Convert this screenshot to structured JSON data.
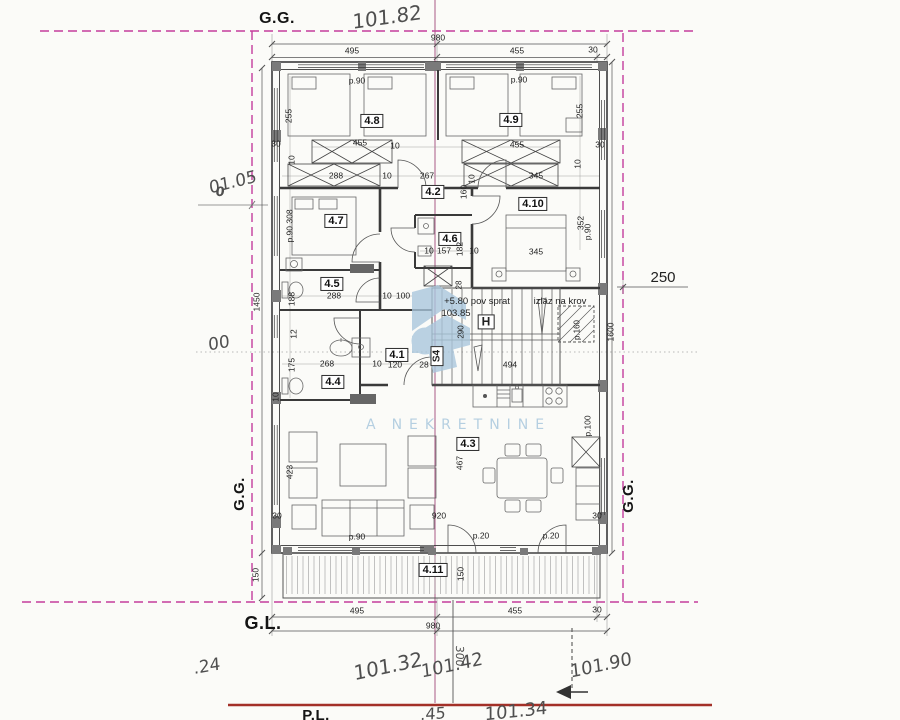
{
  "colors": {
    "boundary": "#c43c9c",
    "survey_line": "#a85a86",
    "ground_line": "#a33028",
    "ink": "#3a3a3a",
    "watermark": "#a9c6dc"
  },
  "watermark": {
    "prefix": "A",
    "text": "NEKRETNINE"
  },
  "texts": {
    "site": [
      {
        "n": "gg-top-label",
        "t": "G.G.",
        "x": 277,
        "y": 19
      },
      {
        "n": "gg-left-label",
        "t": "G.G.",
        "x": 240,
        "y": 494,
        "r": -90,
        "fs": 15
      },
      {
        "n": "gg-right-label",
        "t": "G.G.",
        "x": 629,
        "y": 496,
        "r": -90,
        "fs": 15
      },
      {
        "n": "gl-bottom-label",
        "t": "G.L.",
        "x": 263,
        "y": 624,
        "fs": 18
      },
      {
        "n": "pl-bottom-label",
        "t": "P.L.",
        "x": 316,
        "y": 716,
        "fs": 15
      }
    ],
    "hand": [
      {
        "n": "elevation-top",
        "t": "101.82",
        "x": 387,
        "y": 17,
        "r": -8,
        "fs": 20
      },
      {
        "n": "elevation-left-upper",
        "t": "01.05",
        "x": 233,
        "y": 183,
        "r": -14,
        "fs": 17
      },
      {
        "n": "elevation-left-zero",
        "t": "0",
        "x": 220,
        "y": 193,
        "fs": 13,
        "b": 1
      },
      {
        "n": "elevation-left-lower",
        "t": "00",
        "x": 219,
        "y": 344,
        "r": -10,
        "fs": 17
      },
      {
        "n": "elevation-bottom-24",
        "t": ".24",
        "x": 207,
        "y": 667,
        "r": -10,
        "fs": 17
      },
      {
        "n": "elevation-bottom-10132",
        "t": "101.32",
        "x": 388,
        "y": 666,
        "r": -12,
        "fs": 20
      },
      {
        "n": "elevation-bottom-10142",
        "t": "101.42",
        "x": 452,
        "y": 666,
        "r": -12,
        "fs": 18
      },
      {
        "n": "elevation-bottom-10190",
        "t": "101.90",
        "x": 601,
        "y": 666,
        "r": -12,
        "fs": 18
      },
      {
        "n": "elevation-bottom-45",
        "t": ".45",
        "x": 433,
        "y": 714,
        "r": -4,
        "fs": 16
      },
      {
        "n": "elevation-bottom-10134",
        "t": "101.34",
        "x": 516,
        "y": 712,
        "r": -6,
        "fs": 18
      },
      {
        "n": "survey-300",
        "t": "300",
        "x": 459,
        "y": 656,
        "r": 90,
        "fs": 11
      }
    ],
    "rooms": [
      {
        "n": "room-label-4-8",
        "t": "4.8",
        "x": 372,
        "y": 121
      },
      {
        "n": "room-label-4-9",
        "t": "4.9",
        "x": 511,
        "y": 120
      },
      {
        "n": "room-label-4-2",
        "t": "4.2",
        "x": 433,
        "y": 192
      },
      {
        "n": "room-label-4-7",
        "t": "4.7",
        "x": 336,
        "y": 221
      },
      {
        "n": "room-label-4-10",
        "t": "4.10",
        "x": 533,
        "y": 204
      },
      {
        "n": "room-label-4-6",
        "t": "4.6",
        "x": 450,
        "y": 239
      },
      {
        "n": "room-label-4-5",
        "t": "4.5",
        "x": 332,
        "y": 284
      },
      {
        "n": "room-label-4-1",
        "t": "4.1",
        "x": 397,
        "y": 355
      },
      {
        "n": "room-label-4-4",
        "t": "4.4",
        "x": 333,
        "y": 382
      },
      {
        "n": "room-label-4-3",
        "t": "4.3",
        "x": 468,
        "y": 444
      },
      {
        "n": "room-label-4-11",
        "t": "4.11",
        "x": 433,
        "y": 570
      }
    ],
    "stair": [
      {
        "n": "stair-h-label",
        "t": "H",
        "x": 486,
        "y": 322,
        "box": 1,
        "b": 1,
        "fs": 12
      },
      {
        "n": "stair-s4-label",
        "t": "S4",
        "x": 437,
        "y": 356,
        "box": 1,
        "b": 1,
        "fs": 10,
        "r": -90
      },
      {
        "n": "level-note",
        "t": "+5.80 pov sprat",
        "x": 477,
        "y": 302
      },
      {
        "n": "level-value",
        "t": "103.85",
        "x": 456,
        "y": 314
      },
      {
        "n": "roof-exit-note",
        "t": "izlaz na krov",
        "x": 560,
        "y": 302
      },
      {
        "n": "dim-494",
        "t": "494",
        "x": 510,
        "y": 365,
        "fs": 8.5
      },
      {
        "n": "dim-p160",
        "t": "p.160",
        "x": 578,
        "y": 330,
        "r": -90,
        "fs": 8
      },
      {
        "n": "dim-290",
        "t": "290",
        "x": 462,
        "y": 332,
        "r": -90,
        "fs": 8
      },
      {
        "n": "dim-28-stair",
        "t": "28",
        "x": 460,
        "y": 285,
        "r": -90,
        "fs": 8
      }
    ],
    "dims": [
      {
        "n": "dim-top-980",
        "t": "980",
        "x": 438,
        "y": 38
      },
      {
        "n": "dim-top-495",
        "t": "495",
        "x": 352,
        "y": 51
      },
      {
        "n": "dim-top-455",
        "t": "455",
        "x": 517,
        "y": 51
      },
      {
        "n": "dim-top-30",
        "t": "30",
        "x": 593,
        "y": 50
      },
      {
        "n": "dim-bottom-495",
        "t": "495",
        "x": 357,
        "y": 611
      },
      {
        "n": "dim-bottom-455",
        "t": "455",
        "x": 515,
        "y": 611
      },
      {
        "n": "dim-bottom-30",
        "t": "30",
        "x": 597,
        "y": 610
      },
      {
        "n": "dim-bottom-980",
        "t": "980",
        "x": 433,
        "y": 626
      },
      {
        "n": "dim-left-1450",
        "t": "1450",
        "x": 257,
        "y": 302,
        "r": -90
      },
      {
        "n": "dim-left-150",
        "t": "150",
        "x": 256,
        "y": 575,
        "r": -90
      },
      {
        "n": "dim-right-1600",
        "t": "1600",
        "x": 611,
        "y": 332,
        "r": -90
      },
      {
        "n": "dim-right-250",
        "t": "250",
        "x": 663,
        "y": 278,
        "fs": 15
      },
      {
        "n": "dim-p90-room48",
        "t": "p.90",
        "x": 357,
        "y": 81
      },
      {
        "n": "dim-p90-room49",
        "t": "p.90",
        "x": 519,
        "y": 80
      },
      {
        "n": "dim-255-left",
        "t": "255",
        "x": 289,
        "y": 116,
        "r": -90
      },
      {
        "n": "dim-255-right",
        "t": "255",
        "x": 580,
        "y": 111,
        "r": -90
      },
      {
        "n": "dim-30-tl",
        "t": "30",
        "x": 276,
        "y": 144
      },
      {
        "n": "dim-10-a",
        "t": "10",
        "x": 292,
        "y": 160,
        "r": -90
      },
      {
        "n": "dim-455-wl",
        "t": "455",
        "x": 360,
        "y": 143
      },
      {
        "n": "dim-10-b",
        "t": "10",
        "x": 395,
        "y": 146
      },
      {
        "n": "dim-288-w",
        "t": "288",
        "x": 336,
        "y": 176
      },
      {
        "n": "dim-10-c",
        "t": "10",
        "x": 387,
        "y": 176
      },
      {
        "n": "dim-267",
        "t": "267",
        "x": 427,
        "y": 176
      },
      {
        "n": "dim-160",
        "t": "160",
        "x": 464,
        "y": 192,
        "r": -90
      },
      {
        "n": "dim-455-wr",
        "t": "455",
        "x": 517,
        "y": 145
      },
      {
        "n": "dim-30-tr",
        "t": "30",
        "x": 600,
        "y": 145
      },
      {
        "n": "dim-10-d",
        "t": "10",
        "x": 578,
        "y": 164,
        "r": -90
      },
      {
        "n": "dim-345-w",
        "t": "345",
        "x": 536,
        "y": 176
      },
      {
        "n": "dim-10-e",
        "t": "10",
        "x": 472,
        "y": 179,
        "r": -90
      },
      {
        "n": "dim-p90-308",
        "t": "p.90 308",
        "x": 290,
        "y": 226,
        "r": -90
      },
      {
        "n": "dim-345-room410",
        "t": "345",
        "x": 536,
        "y": 252
      },
      {
        "n": "dim-352",
        "t": "352",
        "x": 581,
        "y": 223,
        "r": -90
      },
      {
        "n": "dim-p90-right",
        "t": "p.90",
        "x": 588,
        "y": 232,
        "r": -90
      },
      {
        "n": "dim-10-f",
        "t": "10",
        "x": 429,
        "y": 251
      },
      {
        "n": "dim-157",
        "t": "157",
        "x": 444,
        "y": 251
      },
      {
        "n": "dim-182",
        "t": "182",
        "x": 460,
        "y": 249,
        "r": -90
      },
      {
        "n": "dim-10-g",
        "t": "10",
        "x": 474,
        "y": 251
      },
      {
        "n": "dim-288-45",
        "t": "288",
        "x": 334,
        "y": 296
      },
      {
        "n": "dim-10-h",
        "t": "10",
        "x": 387,
        "y": 296
      },
      {
        "n": "dim-100",
        "t": "100",
        "x": 403,
        "y": 296
      },
      {
        "n": "dim-188",
        "t": "188",
        "x": 292,
        "y": 299,
        "r": -90
      },
      {
        "n": "dim-12",
        "t": "12",
        "x": 294,
        "y": 334,
        "r": -90
      },
      {
        "n": "dim-175",
        "t": "175",
        "x": 292,
        "y": 365,
        "r": -90
      },
      {
        "n": "dim-10-i",
        "t": "10",
        "x": 276,
        "y": 397,
        "r": -90
      },
      {
        "n": "dim-268",
        "t": "268",
        "x": 327,
        "y": 364
      },
      {
        "n": "dim-10-j",
        "t": "10",
        "x": 377,
        "y": 364
      },
      {
        "n": "dim-120",
        "t": "120",
        "x": 395,
        "y": 365
      },
      {
        "n": "dim-28",
        "t": "28",
        "x": 424,
        "y": 365
      },
      {
        "n": "dim-467",
        "t": "467",
        "x": 460,
        "y": 463,
        "r": -90
      },
      {
        "n": "dim-920",
        "t": "920",
        "x": 439,
        "y": 516
      },
      {
        "n": "dim-423",
        "t": "423",
        "x": 290,
        "y": 472,
        "r": -90
      },
      {
        "n": "dim-30-bl",
        "t": "30",
        "x": 277,
        "y": 516
      },
      {
        "n": "dim-30-br",
        "t": "30",
        "x": 597,
        "y": 516
      },
      {
        "n": "dim-p90-sofa",
        "t": "p.90",
        "x": 357,
        "y": 537
      },
      {
        "n": "dim-p20-a",
        "t": "p.20",
        "x": 481,
        "y": 536
      },
      {
        "n": "dim-p20-b",
        "t": "p.20",
        "x": 551,
        "y": 536
      },
      {
        "n": "dim-p100",
        "t": "p.100",
        "x": 588,
        "y": 426,
        "r": -90
      },
      {
        "n": "dim-150-terrace",
        "t": "150",
        "x": 461,
        "y": 574,
        "r": -90
      }
    ]
  }
}
